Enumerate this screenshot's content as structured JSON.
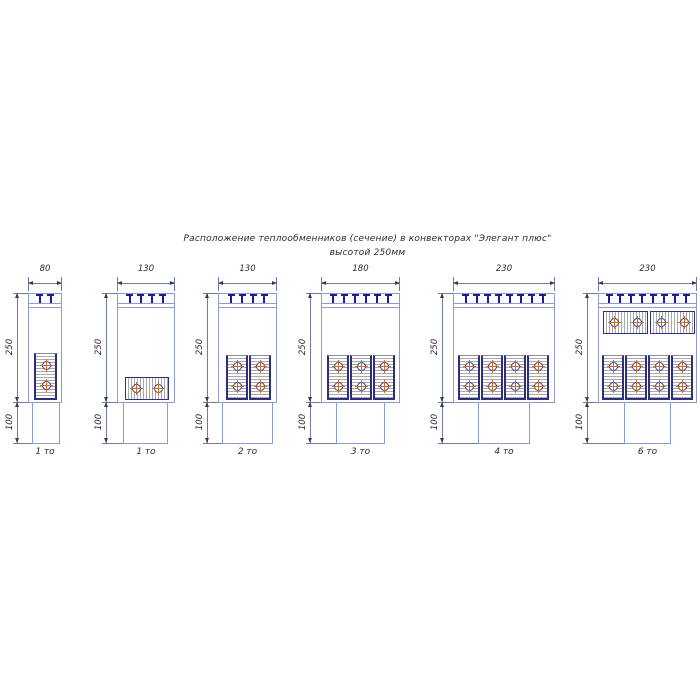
{
  "title": {
    "line1": "Расположение теплообменников (сечение) в конвекторах \"Элегант плюс\"",
    "line2": "высотой 250мм"
  },
  "colors": {
    "outline": "#8d9cce",
    "clip": "#1c1c96",
    "hatch": "#a9a9a9",
    "exch_border": "#8a8aa8",
    "exch_edge": "#2e2e7a",
    "tube_ring": "#3a3a7a",
    "cross": "#c96a30",
    "dim": "#6f7d9c",
    "arrow": "#3a3a55",
    "text": "#2b2b2b"
  },
  "common": {
    "box_top": 293,
    "box_bottom": 402,
    "pedestal_bottom": 443,
    "strip_y1": 303,
    "strip_y2": 307,
    "top_dim_y": 283,
    "top_ext_top": 277,
    "top_label_y": 264,
    "clip_spacing": 11,
    "dim_offset": 11,
    "caption_y": 447,
    "height_label": "250",
    "base_label": "100"
  },
  "diagrams": [
    {
      "caption": "1 то",
      "width_label": "80",
      "box": {
        "x": 28,
        "w": 34
      },
      "pedestal": {
        "x": 32,
        "w": 28
      },
      "clips": 2,
      "exchangers": [
        {
          "o": "v",
          "x": 34,
          "y": 353,
          "w": 23,
          "h": 47,
          "circles": [
            [
              46,
              365
            ],
            [
              46,
              385
            ]
          ]
        }
      ]
    },
    {
      "caption": "1 то",
      "width_label": "130",
      "box": {
        "x": 117,
        "w": 58
      },
      "pedestal": {
        "x": 123,
        "w": 45
      },
      "clips": 4,
      "exchangers": [
        {
          "o": "h",
          "x": 125,
          "y": 377,
          "w": 44,
          "h": 23,
          "circles": [
            [
              136,
              388
            ],
            [
              158,
              388
            ]
          ]
        }
      ]
    },
    {
      "caption": "2 то",
      "width_label": "130",
      "box": {
        "x": 218,
        "w": 59
      },
      "pedestal": {
        "x": 222,
        "w": 51
      },
      "clips": 4,
      "exchangers": [
        {
          "o": "v",
          "x": 226,
          "y": 355,
          "w": 22,
          "h": 45,
          "circles": [
            [
              237,
              366
            ],
            [
              237,
              386
            ]
          ]
        },
        {
          "o": "v",
          "x": 249,
          "y": 355,
          "w": 22,
          "h": 45,
          "circles": [
            [
              260,
              366
            ],
            [
              260,
              386
            ]
          ]
        }
      ]
    },
    {
      "caption": "3 то",
      "width_label": "180",
      "box": {
        "x": 321,
        "w": 79
      },
      "pedestal": {
        "x": 336,
        "w": 49
      },
      "clips": 6,
      "exchangers": [
        {
          "o": "v",
          "x": 327,
          "y": 355,
          "w": 22,
          "h": 45,
          "circles": [
            [
              338,
              366
            ],
            [
              338,
              386
            ]
          ]
        },
        {
          "o": "v",
          "x": 350,
          "y": 355,
          "w": 22,
          "h": 45,
          "circles": [
            [
              361,
              366
            ],
            [
              361,
              386
            ]
          ]
        },
        {
          "o": "v",
          "x": 373,
          "y": 355,
          "w": 22,
          "h": 45,
          "circles": [
            [
              384,
              366
            ],
            [
              384,
              386
            ]
          ]
        }
      ]
    },
    {
      "caption": "4 то",
      "width_label": "230",
      "box": {
        "x": 453,
        "w": 102
      },
      "pedestal": {
        "x": 478,
        "w": 52
      },
      "clips": 8,
      "exchangers": [
        {
          "o": "v",
          "x": 458,
          "y": 355,
          "w": 22,
          "h": 45,
          "circles": [
            [
              469,
              366
            ],
            [
              469,
              386
            ]
          ]
        },
        {
          "o": "v",
          "x": 481,
          "y": 355,
          "w": 22,
          "h": 45,
          "circles": [
            [
              492,
              366
            ],
            [
              492,
              386
            ]
          ]
        },
        {
          "o": "v",
          "x": 504,
          "y": 355,
          "w": 22,
          "h": 45,
          "circles": [
            [
              515,
              366
            ],
            [
              515,
              386
            ]
          ]
        },
        {
          "o": "v",
          "x": 527,
          "y": 355,
          "w": 22,
          "h": 45,
          "circles": [
            [
              538,
              366
            ],
            [
              538,
              386
            ]
          ]
        }
      ]
    },
    {
      "caption": "6 то",
      "width_label": "230",
      "box": {
        "x": 598,
        "w": 99
      },
      "pedestal": {
        "x": 624,
        "w": 47
      },
      "clips": 8,
      "exchangers": [
        {
          "o": "h",
          "x": 603,
          "y": 311,
          "w": 45,
          "h": 23,
          "circles": [
            [
              614,
              322
            ],
            [
              637,
              322
            ]
          ]
        },
        {
          "o": "h",
          "x": 650,
          "y": 311,
          "w": 45,
          "h": 23,
          "circles": [
            [
              661,
              322
            ],
            [
              684,
              322
            ]
          ]
        },
        {
          "o": "v",
          "x": 602,
          "y": 355,
          "w": 22,
          "h": 45,
          "circles": [
            [
              613,
              366
            ],
            [
              613,
              386
            ]
          ]
        },
        {
          "o": "v",
          "x": 625,
          "y": 355,
          "w": 22,
          "h": 45,
          "circles": [
            [
              636,
              366
            ],
            [
              636,
              386
            ]
          ]
        },
        {
          "o": "v",
          "x": 648,
          "y": 355,
          "w": 22,
          "h": 45,
          "circles": [
            [
              659,
              366
            ],
            [
              659,
              386
            ]
          ]
        },
        {
          "o": "v",
          "x": 671,
          "y": 355,
          "w": 22,
          "h": 45,
          "circles": [
            [
              682,
              366
            ],
            [
              682,
              386
            ]
          ]
        }
      ]
    }
  ]
}
